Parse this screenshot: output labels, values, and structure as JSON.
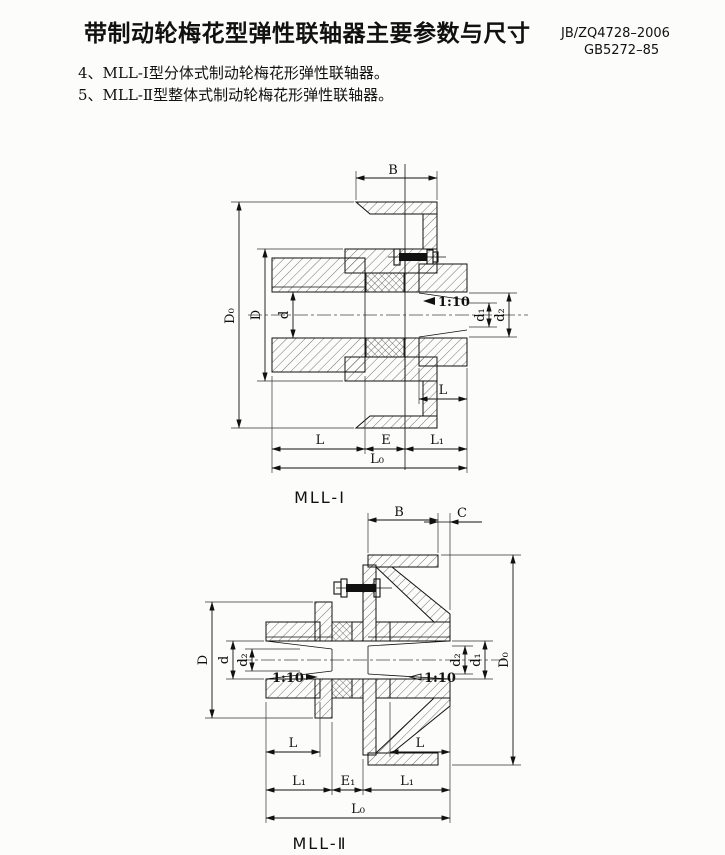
{
  "page": {
    "title": "带制动轮梅花型弹性联轴器主要参数与尺寸",
    "standard_1": "JB/ZQ4728–2006",
    "standard_2": "GB5272–85",
    "note_4": "4、MLL-Ⅰ型分体式制动轮梅花形弹性联轴器。",
    "note_5": "5、MLL-Ⅱ型整体式制动轮梅花形弹性联轴器。"
  },
  "figure1": {
    "caption": "MLL-Ⅰ",
    "taper": "1:10",
    "dims": {
      "B": "B",
      "D0": "D₀",
      "D": "D",
      "d": "d",
      "d1": "d₁",
      "d2": "d₂",
      "L_right": "L",
      "L": "L",
      "E": "E",
      "L1": "L₁",
      "L0": "L₀"
    }
  },
  "figure2": {
    "caption": "MLL-Ⅱ",
    "taper_left": "1:10",
    "taper_right": "1:10",
    "dims": {
      "B": "B",
      "C": "C",
      "D0": "D₀",
      "D": "D",
      "d": "d",
      "d2_left": "d₂",
      "d2_right": "d₂",
      "d1": "d₁",
      "L_left": "L",
      "L_right": "L",
      "L1_left": "L₁",
      "E1": "E₁",
      "L1_right": "L₁",
      "L0": "L₀"
    }
  }
}
